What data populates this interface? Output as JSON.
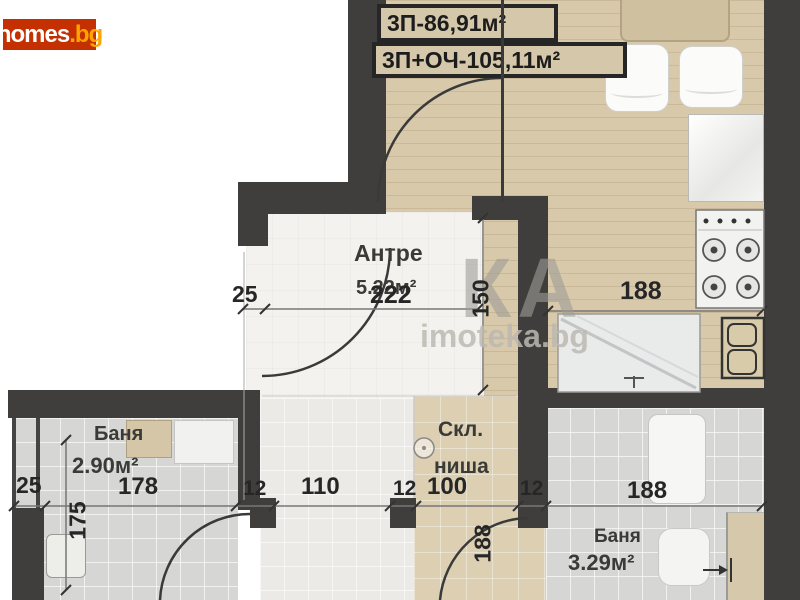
{
  "logo": {
    "text": "homes",
    "suffix": ".bg"
  },
  "header": {
    "line1": "3П-86,91м²",
    "line2": "3П+ОЧ-105,11м²"
  },
  "watermark": {
    "letters": "КА",
    "site": "imoteka.bg"
  },
  "rooms": {
    "hall": {
      "name": "Антре",
      "area": "5.22м²"
    },
    "niche": {
      "line1": "Скл.",
      "line2": "ниша"
    },
    "bath_left": {
      "name": "Баня",
      "area": "2.90м²"
    },
    "bath_right": {
      "name": "Баня",
      "area": "3.29м²"
    }
  },
  "dims": {
    "hall_w": "222",
    "hall_h": "150",
    "post_w": "25",
    "kitchen_w": "188",
    "bl_corner": "25",
    "bl_w": "178",
    "bl_h": "175",
    "jamb_a": "12",
    "corridor_w": "110",
    "jamb_b": "12",
    "niche_w": "100",
    "jamb_c": "12",
    "br_w": "188",
    "niche_h": "188"
  },
  "colors": {
    "wall": "#3f3e3c",
    "kitchen_floor": "#d8c9ab",
    "logo_bg": "#c43000",
    "logo_suffix": "#ffa400"
  }
}
